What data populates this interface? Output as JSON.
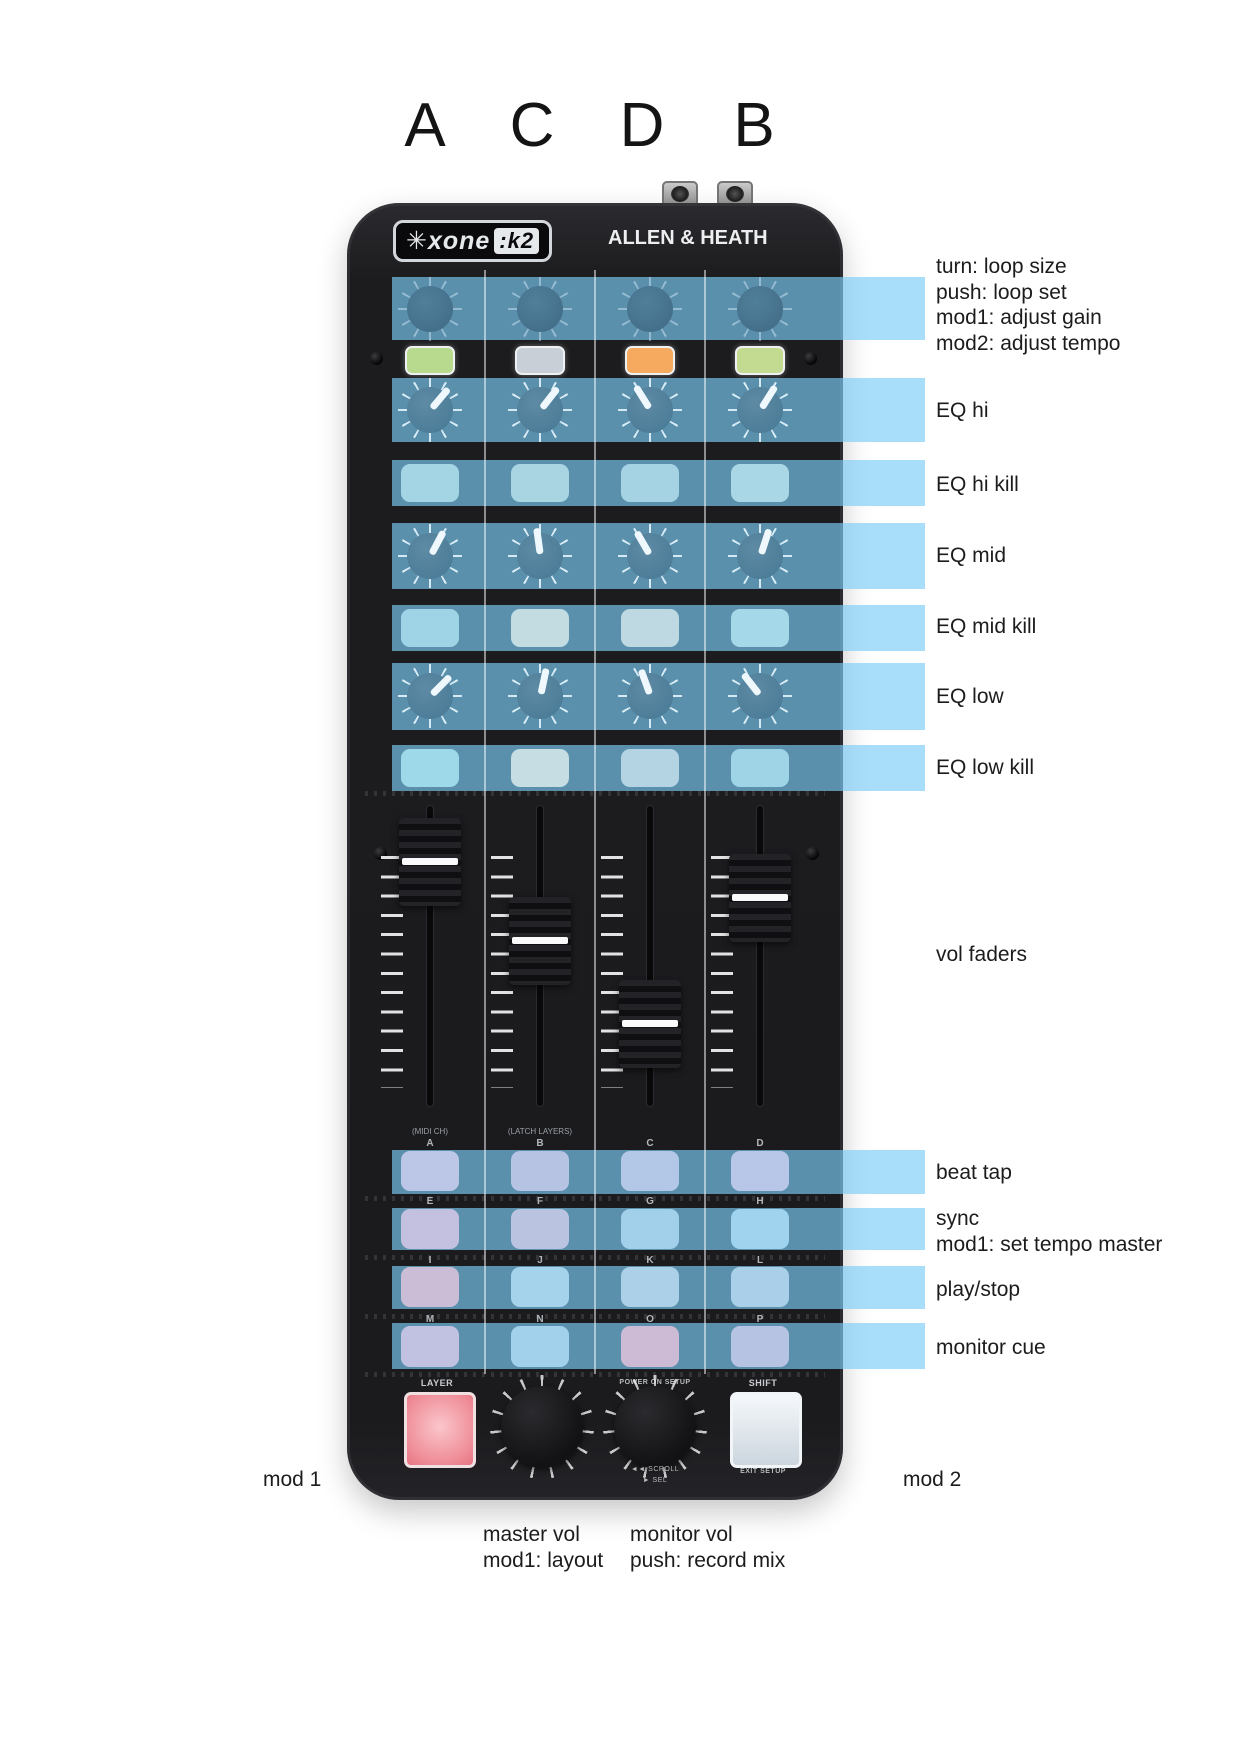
{
  "deck_letters": [
    "A",
    "C",
    "D",
    "B"
  ],
  "device": {
    "logo_left": "✳xone",
    "logo_right": ":k2",
    "brand": "ALLEN & HEATH",
    "midi_ch_label": "(MIDI CH)",
    "latch_layers_label": "(LATCH LAYERS)",
    "grid_letters": [
      "A",
      "B",
      "C",
      "D",
      "E",
      "F",
      "G",
      "H",
      "I",
      "J",
      "K",
      "L",
      "M",
      "N",
      "O",
      "P"
    ],
    "layer_label": "LAYER",
    "shift_label": "SHIFT",
    "power_on_setup_label": "POWER ON SETUP",
    "scroll_label": "◄◄ SCROLL",
    "sel_label": "► SEL",
    "exit_setup_label": "EXIT SETUP",
    "led_colors": [
      "#b7da8e",
      "#c9cfd7",
      "#f6aa60",
      "#c3db90"
    ],
    "kill_colors": [
      "#a3d5e4",
      "#a9d4e2",
      "#a6d3e4",
      "#a9d7e6",
      "#9fd4e6",
      "#c3dce2",
      "#bfd9e2",
      "#a5d8e8",
      "#9ed9ea",
      "#c6dde4",
      "#b4d4e4",
      "#9ed4e6"
    ],
    "grid_colors": [
      "#bcc6e6",
      "#b6c3e3",
      "#b3c7e6",
      "#b8c7e8",
      "#c3c0e0",
      "#bac4e1",
      "#a2cfea",
      "#a0d3ee",
      "#ccbdd7",
      "#a5d3ec",
      "#add0e9",
      "#aad0e9",
      "#c1c1e1",
      "#a2d1eb",
      "#cdbad5",
      "#b6c3e3"
    ],
    "eq_hi_angles": [
      40,
      38,
      -32,
      32
    ],
    "eq_mid_angles": [
      28,
      -8,
      -30,
      18
    ],
    "eq_low_angles": [
      45,
      12,
      -20,
      -38
    ],
    "fader_cap_tops": [
      818,
      897,
      980,
      854
    ],
    "highlight_color": "rgba(125,205,248,0.66)"
  },
  "annotations": {
    "encoder_lines": [
      "turn: loop size",
      "push: loop set",
      "mod1: adjust gain",
      "mod2: adjust tempo"
    ],
    "eq_hi": "EQ hi",
    "eq_hi_kill": "EQ hi kill",
    "eq_mid": "EQ mid",
    "eq_mid_kill": "EQ mid kill",
    "eq_low": "EQ low",
    "eq_low_kill": "EQ low kill",
    "vol_faders": "vol faders",
    "beat_tap": "beat tap",
    "sync_lines": [
      "sync",
      "mod1: set tempo master"
    ],
    "play_stop": "play/stop",
    "monitor_cue": "monitor cue",
    "mod1": "mod 1",
    "mod2": "mod 2",
    "master_vol_lines": [
      "master vol",
      "mod1: layout"
    ],
    "monitor_vol_lines": [
      "monitor vol",
      "push: record mix"
    ]
  }
}
